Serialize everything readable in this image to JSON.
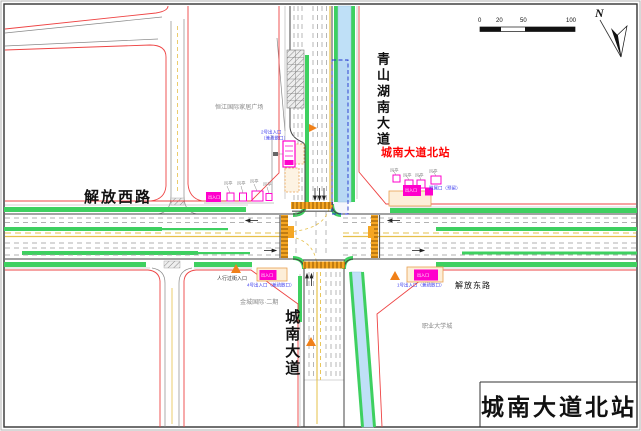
{
  "compass": {
    "label": "N"
  },
  "scale_bar": {
    "ticks": [
      "0",
      "20",
      "50",
      "100"
    ]
  },
  "road_labels": {
    "qingshan_south_ave": "青山湖南大道",
    "chengnan_ave": "城南大道",
    "jiefang_west_rd": "解放西路",
    "jiefang_east_rd": "解放东路"
  },
  "station": {
    "marker": "城南大道北站",
    "title": "城南大道北站"
  },
  "buildings": {
    "northwest_plaza": "恒江国际家居广场",
    "southwest_block": "金城国际·二期",
    "southeast_campus": "职业大学城"
  },
  "notes": {
    "entrance1": "1号出入口（兼疏散口）",
    "entrance2_l1": "2号出入口",
    "entrance2_l2": "（兼疏散口）",
    "entrance4": "4号出入口（兼疏散口）",
    "reserved": "附属口（预留）",
    "ped_crossing": "人行过街入口",
    "entrance_box": "出入口",
    "vent": "风亭"
  },
  "colors": {
    "red_line": "#ee4444",
    "green_strip": "#3ed060",
    "canal": "#bfe0f7",
    "crosswalk": "#f5a623",
    "structure_magenta": "#ff00cc",
    "station_label_red": "#ff0000",
    "note_blue": "#4040ee",
    "center_yellow": "#e6c04a"
  }
}
